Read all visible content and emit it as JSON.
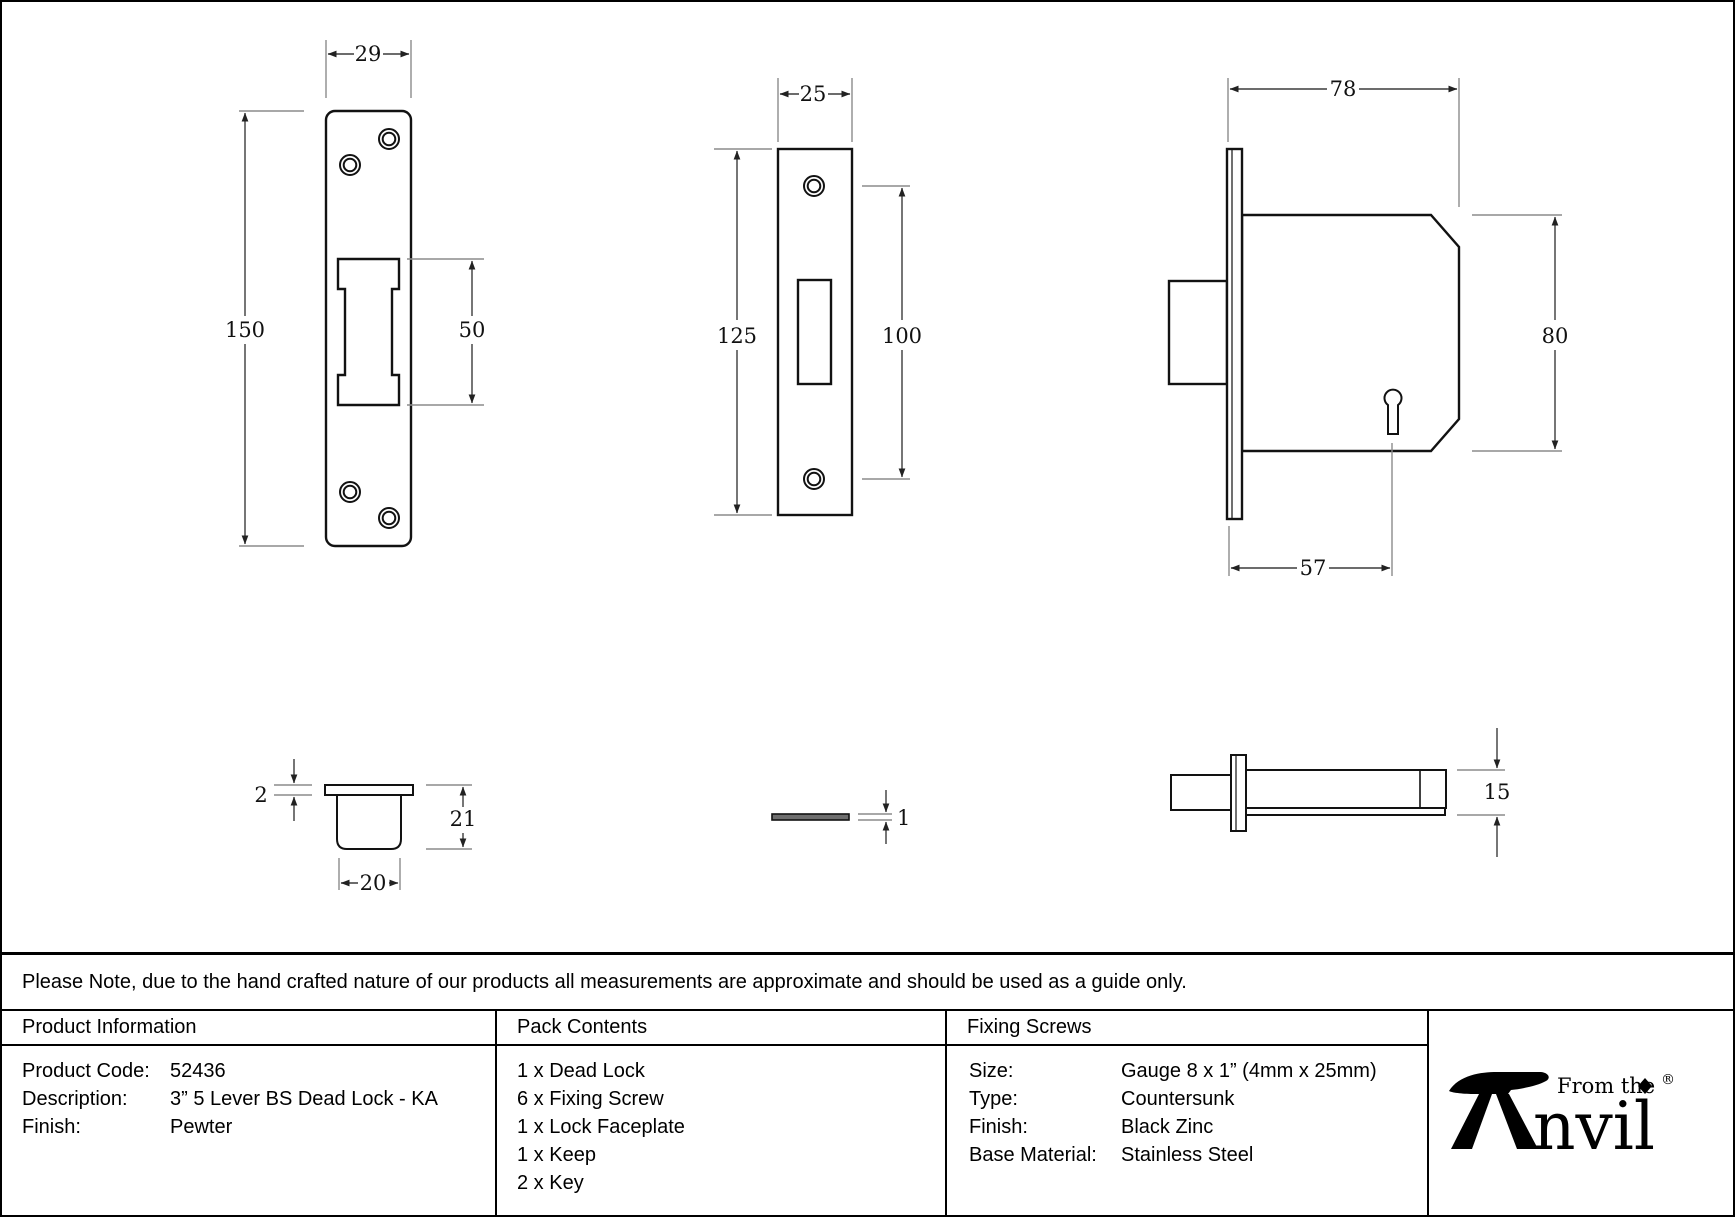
{
  "drawings": {
    "keep_front": {
      "width": "29",
      "height": "150",
      "cutout_height": "50"
    },
    "faceplate_front": {
      "width": "25",
      "height": "125",
      "hole_spacing": "100"
    },
    "lock_front": {
      "case_depth": "78",
      "case_height": "80",
      "backset": "57"
    },
    "keep_section": {
      "lip_thickness": "2",
      "depth": "21",
      "width": "20"
    },
    "faceplate_side": {
      "thickness": "1"
    },
    "lock_side": {
      "thickness": "15"
    }
  },
  "note": {
    "text": "Please Note, due to the hand crafted nature of our products all measurements are approximate and should be used as a guide only."
  },
  "table": {
    "product_information": {
      "header": "Product Information",
      "rows": [
        {
          "label": "Product Code:",
          "value": "52436"
        },
        {
          "label": "Description:",
          "value": "3” 5 Lever BS Dead Lock - KA"
        },
        {
          "label": "Finish:",
          "value": "Pewter"
        }
      ]
    },
    "pack_contents": {
      "header": "Pack Contents",
      "items": [
        "1 x Dead Lock",
        "6 x Fixing Screw",
        "1 x Lock Faceplate",
        "1 x Keep",
        "2 x Key"
      ]
    },
    "fixing_screws": {
      "header": "Fixing Screws",
      "rows": [
        {
          "label": "Size:",
          "value": "Gauge 8 x 1” (4mm x 25mm)"
        },
        {
          "label": "Type:",
          "value": "Countersunk"
        },
        {
          "label": "Finish:",
          "value": "Black Zinc"
        },
        {
          "label": "Base Material:",
          "value": "Stainless Steel"
        }
      ]
    }
  },
  "logo": {
    "tagline": "From the",
    "brand_suffix": "nvil",
    "registered": "®"
  },
  "colors": {
    "line": "#111111",
    "dim": "#3c3c3c",
    "ext": "#8c8c8c",
    "background": "#ffffff"
  }
}
